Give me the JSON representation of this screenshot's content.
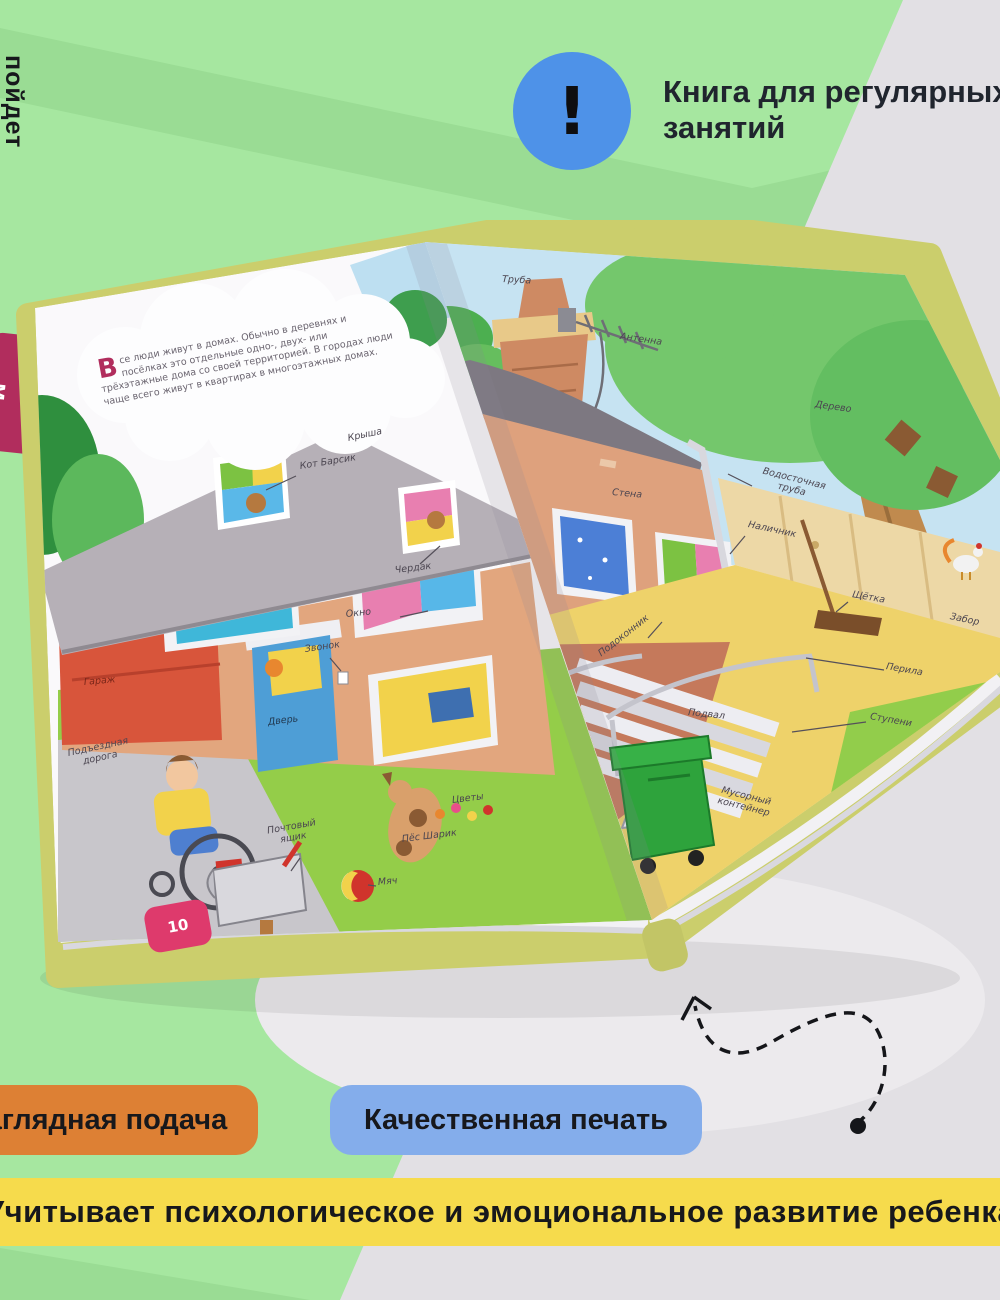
{
  "note": {
    "icon": "!",
    "line1": "Книга для регулярных",
    "line2": "занятий"
  },
  "side_text": "пойдет",
  "pills": {
    "orange": "Наглядная подача",
    "blue": "Качественная печать"
  },
  "banner": "Учитывает психологическое и эмоциональное развитие ребенка",
  "book": {
    "chapter_tab": "м",
    "page_number": "10",
    "intro_dropcap": "В",
    "intro_text": "се люди живут в домах. Обычно в деревнях и посёлках это отдельные одно-, двух- или трёхэтажные дома со своей территорией. В городах люди чаще всего живут в квартирах в многоэтажных домах.",
    "left_labels": [
      "Крыша",
      "Кот Барсик",
      "Чердак",
      "Окно",
      "Звонок",
      "Дверь",
      "Гараж",
      "Подъездная дорога",
      "Почтовый ящик",
      "Пёс Шарик",
      "Мяч",
      "Цветы"
    ],
    "right_labels": [
      "Труба",
      "Антенна",
      "Дерево",
      "Стена",
      "Водосточная труба",
      "Наличник",
      "Щётка",
      "Забор",
      "Перила",
      "Ступени",
      "Подоконник",
      "Подвал",
      "Мусорный контейнер"
    ]
  },
  "colors": {
    "background": "#A6E7A0",
    "chevron": "#9ADC94",
    "panel_gray": "#E2E0E4",
    "note_circle": "#4E92E8",
    "pill_orange": "#DD8034",
    "pill_blue": "#84ADEB",
    "banner_yellow": "#F6DB4C",
    "book_cover": "#CBCE6C",
    "tab_pink": "#B12D5D",
    "badge_pink": "#DE3A6C"
  }
}
